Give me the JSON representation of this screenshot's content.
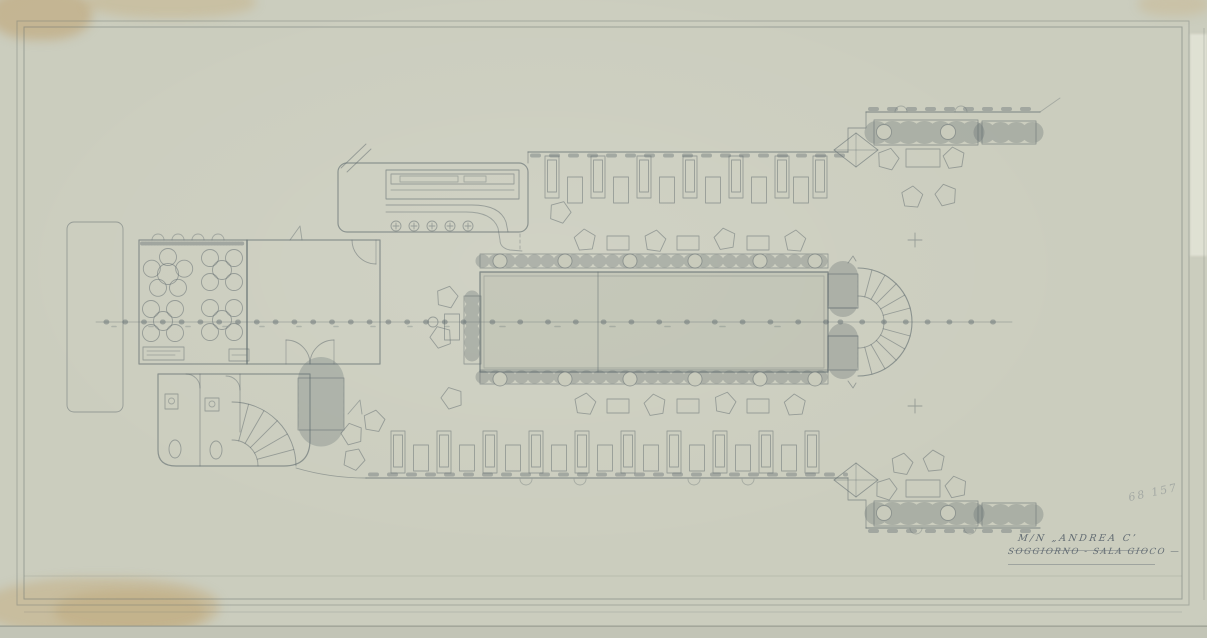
{
  "sheet": {
    "title_line1": "M/N „ANDREA C’",
    "title_line2": "SOGGIORNO - SALA GIOCO —",
    "corner_mark": "68 157"
  },
  "colors": {
    "paper": "#c8cabb",
    "pencil_line": "#5f6a6e",
    "stain_tan": "#c3a06c",
    "title_ink": "#4a5662"
  },
  "drawing": {
    "kind": "ship deck plan",
    "rooms_depicted": "lounge and game room deck with bar, dining tables, promenade benches, stern stair fan, toilets"
  }
}
